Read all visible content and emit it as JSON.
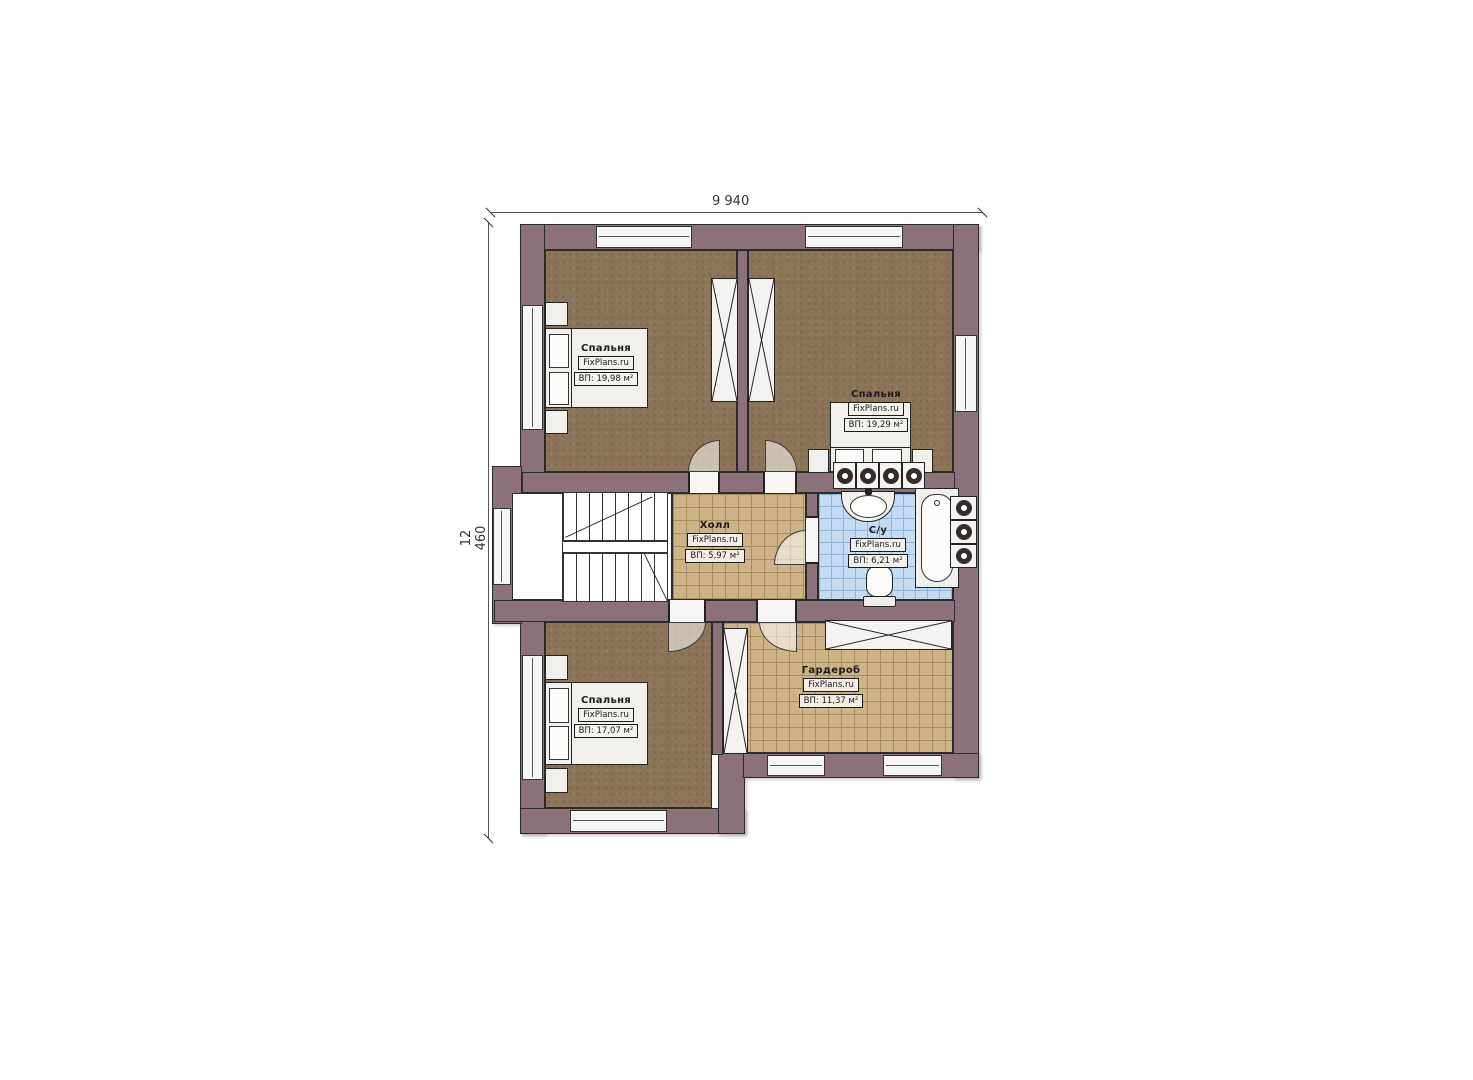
{
  "plan": {
    "title": "Floor plan — second storey",
    "dim_width": "9 940",
    "dim_height": "12 460",
    "rooms": [
      {
        "key": "bedroom-top-left",
        "name": "Спальня",
        "source": "FixPlans.ru",
        "area": "ВП: 19,98 м²"
      },
      {
        "key": "bedroom-top-right",
        "name": "Спальня",
        "source": "FixPlans.ru",
        "area": "ВП: 19,29 м²"
      },
      {
        "key": "hall",
        "name": "Холл",
        "source": "FixPlans.ru",
        "area": "ВП: 5,97 м²"
      },
      {
        "key": "bathroom",
        "name": "С/у",
        "source": "FixPlans.ru",
        "area": "ВП: 6,21 м²"
      },
      {
        "key": "bedroom-bottom-left",
        "name": "Спальня",
        "source": "FixPlans.ru",
        "area": "ВП: 17,07 м²"
      },
      {
        "key": "wardrobe",
        "name": "Гардероб",
        "source": "FixPlans.ru",
        "area": "ВП: 11,37 м²"
      }
    ],
    "colors": {
      "wall": "#8b727a",
      "outline": "#2b2b2b",
      "bedroom_floor": "#8d7557",
      "hall_floor": "#ccb487",
      "bathroom_floor": "#c5dbf2",
      "fixture": "#f1f0ec"
    }
  }
}
